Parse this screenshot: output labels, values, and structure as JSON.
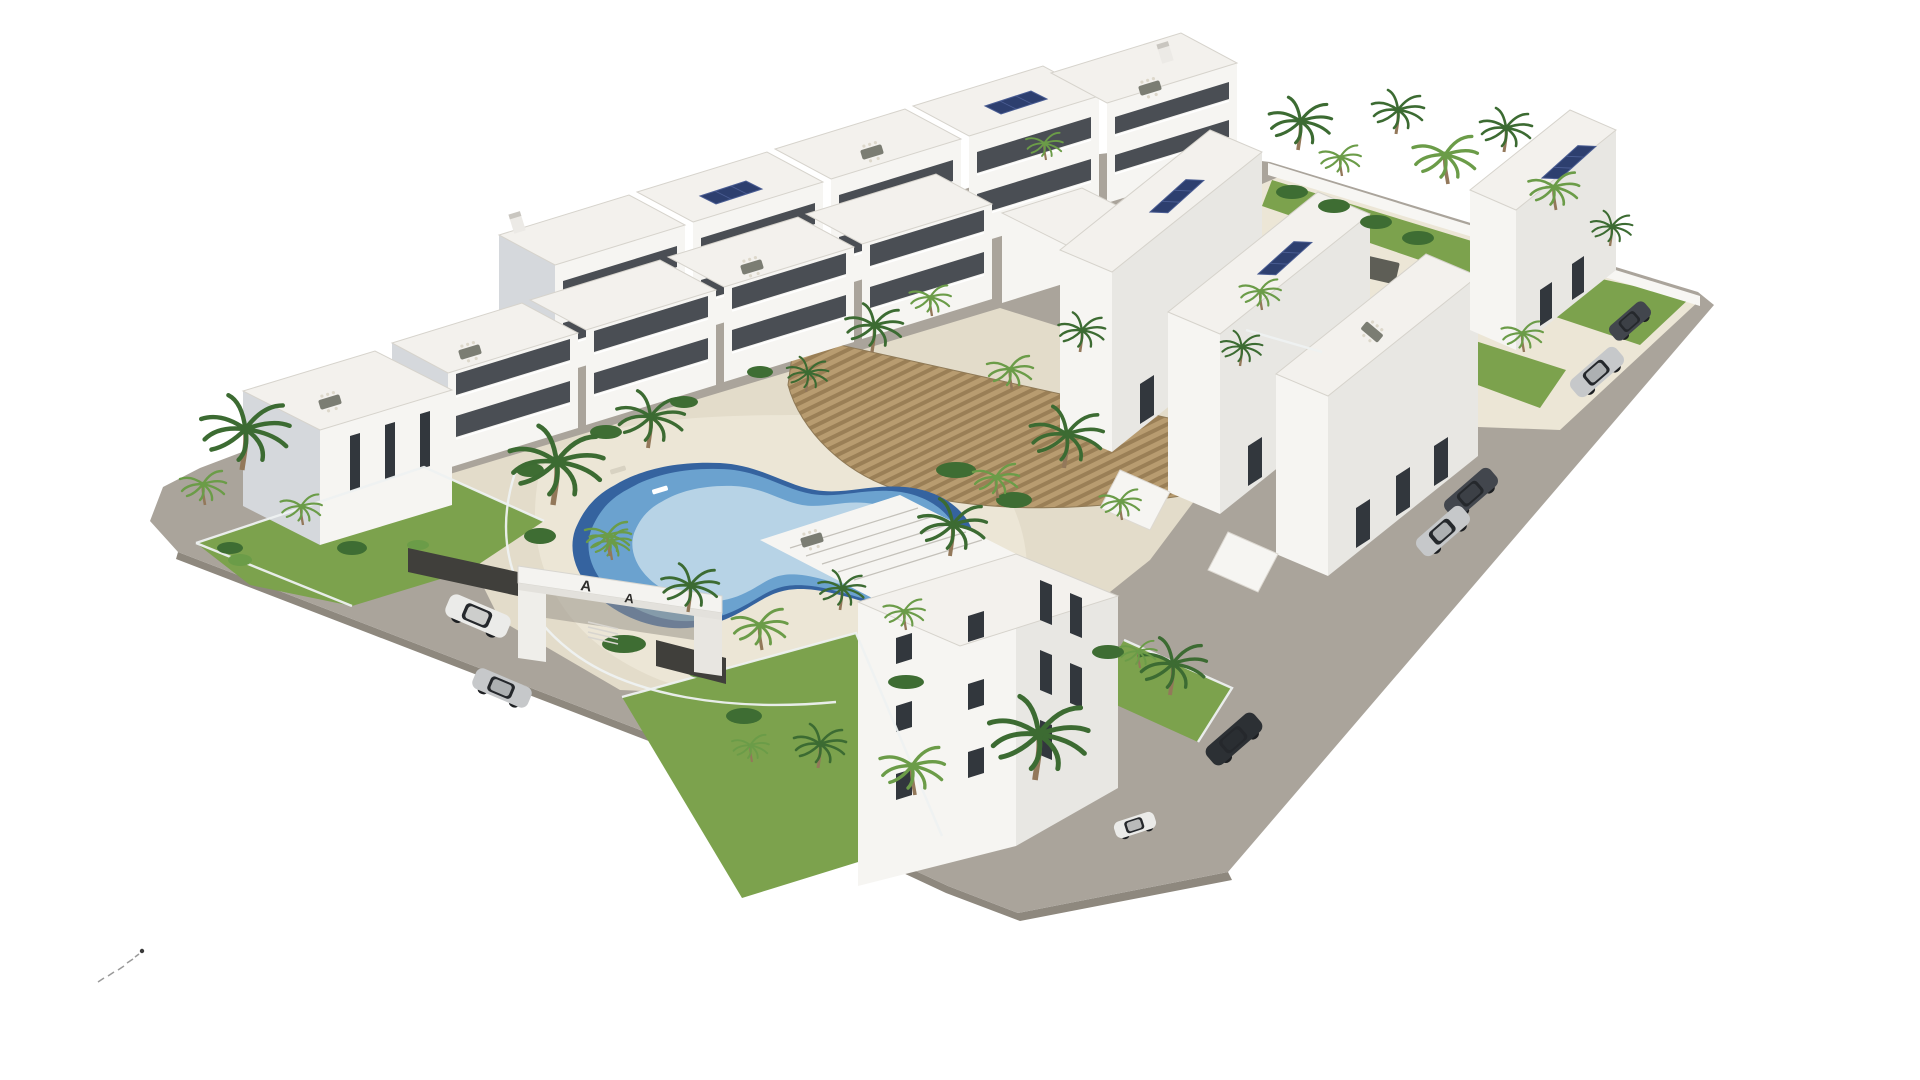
{
  "scene": {
    "type": "architectural-3d-render",
    "view": "aerial axonometric bird's-eye view",
    "subject": "White modern Mediterranean apartment complex with central lagoon pool, rectangular pool, timber pergola deck, palm trees, roof terraces, solar panels and grey perimeter roads on a plain white background",
    "background": "#ffffff"
  },
  "entrance_gate": {
    "letter_main": "A",
    "letter_small": "A"
  },
  "colors": {
    "road": "#aaa49b",
    "road_edge": "#8e887e",
    "paving": "#e3dcca",
    "paving_light": "#ece6d6",
    "grass": "#7ca24d",
    "shrub": "#3e6d33",
    "palm_dark": "#3c6b32",
    "palm_light": "#6b9c48",
    "trunk": "#93785a",
    "wall_lit": "#f6f5f2",
    "wall_shade": "#d5d8dc",
    "wall_dark": "#e8e7e3",
    "window": "#32373d",
    "roof": "#f3f1ed",
    "parapet": "#d6d3cc",
    "deck": "#b89c70",
    "deck_stripe": "#9a7f56",
    "pool_rim": "#35639f",
    "pool_mid": "#6ba2cf",
    "pool_pale": "#b7d3e6",
    "pool_rect": "#5596c4",
    "pool_ledge": "#9dc3da",
    "solar": "#2d3f6f",
    "solar_line": "#4a5d93",
    "canopy": "#5e5e56",
    "fence_dark": "#403f3b",
    "fence_white": "#eef1f1",
    "car_dark": "#42464d",
    "car_silver": "#c6c8ca",
    "car_white": "#ebebe9",
    "car_black": "#2c3034",
    "glass": "#25282c",
    "mark": "#9a9a9a"
  },
  "site": {
    "pools": [
      "freeform lagoon pool in central courtyard",
      "rectangular pool on north-east terrace"
    ],
    "deck": "curved timber-slat pergola deck across courtyard",
    "roads": "grey perimeter roads on south-west, south and east sides",
    "buildings": [
      "back apartment row with roof terraces and solar panels",
      "front apartment row with balconies",
      "left corner block",
      "stepped east wing with solar panels",
      "far north-east block",
      "south corner block with pergola roof"
    ],
    "vehicles": [
      {
        "color": "white",
        "type": "suv",
        "position": "south-west road by entrance"
      },
      {
        "color": "silver",
        "type": "sedan",
        "position": "south-west road"
      },
      {
        "color": "dark grey",
        "type": "sedan",
        "position": "east road upper"
      },
      {
        "color": "silver",
        "type": "coupe",
        "position": "east road upper"
      },
      {
        "color": "black",
        "type": "suv",
        "position": "east road lower"
      },
      {
        "color": "white",
        "type": "city car",
        "position": "south road near corner"
      },
      {
        "color": "dark grey",
        "type": "hatchback",
        "position": "north-east road"
      },
      {
        "color": "silver",
        "type": "suv",
        "position": "north-east road"
      }
    ],
    "landscaping": "palm trees, lawns and hedges inside white glass-fenced gardens",
    "marks": "faint dashed tick marks near bottom-left corner"
  }
}
